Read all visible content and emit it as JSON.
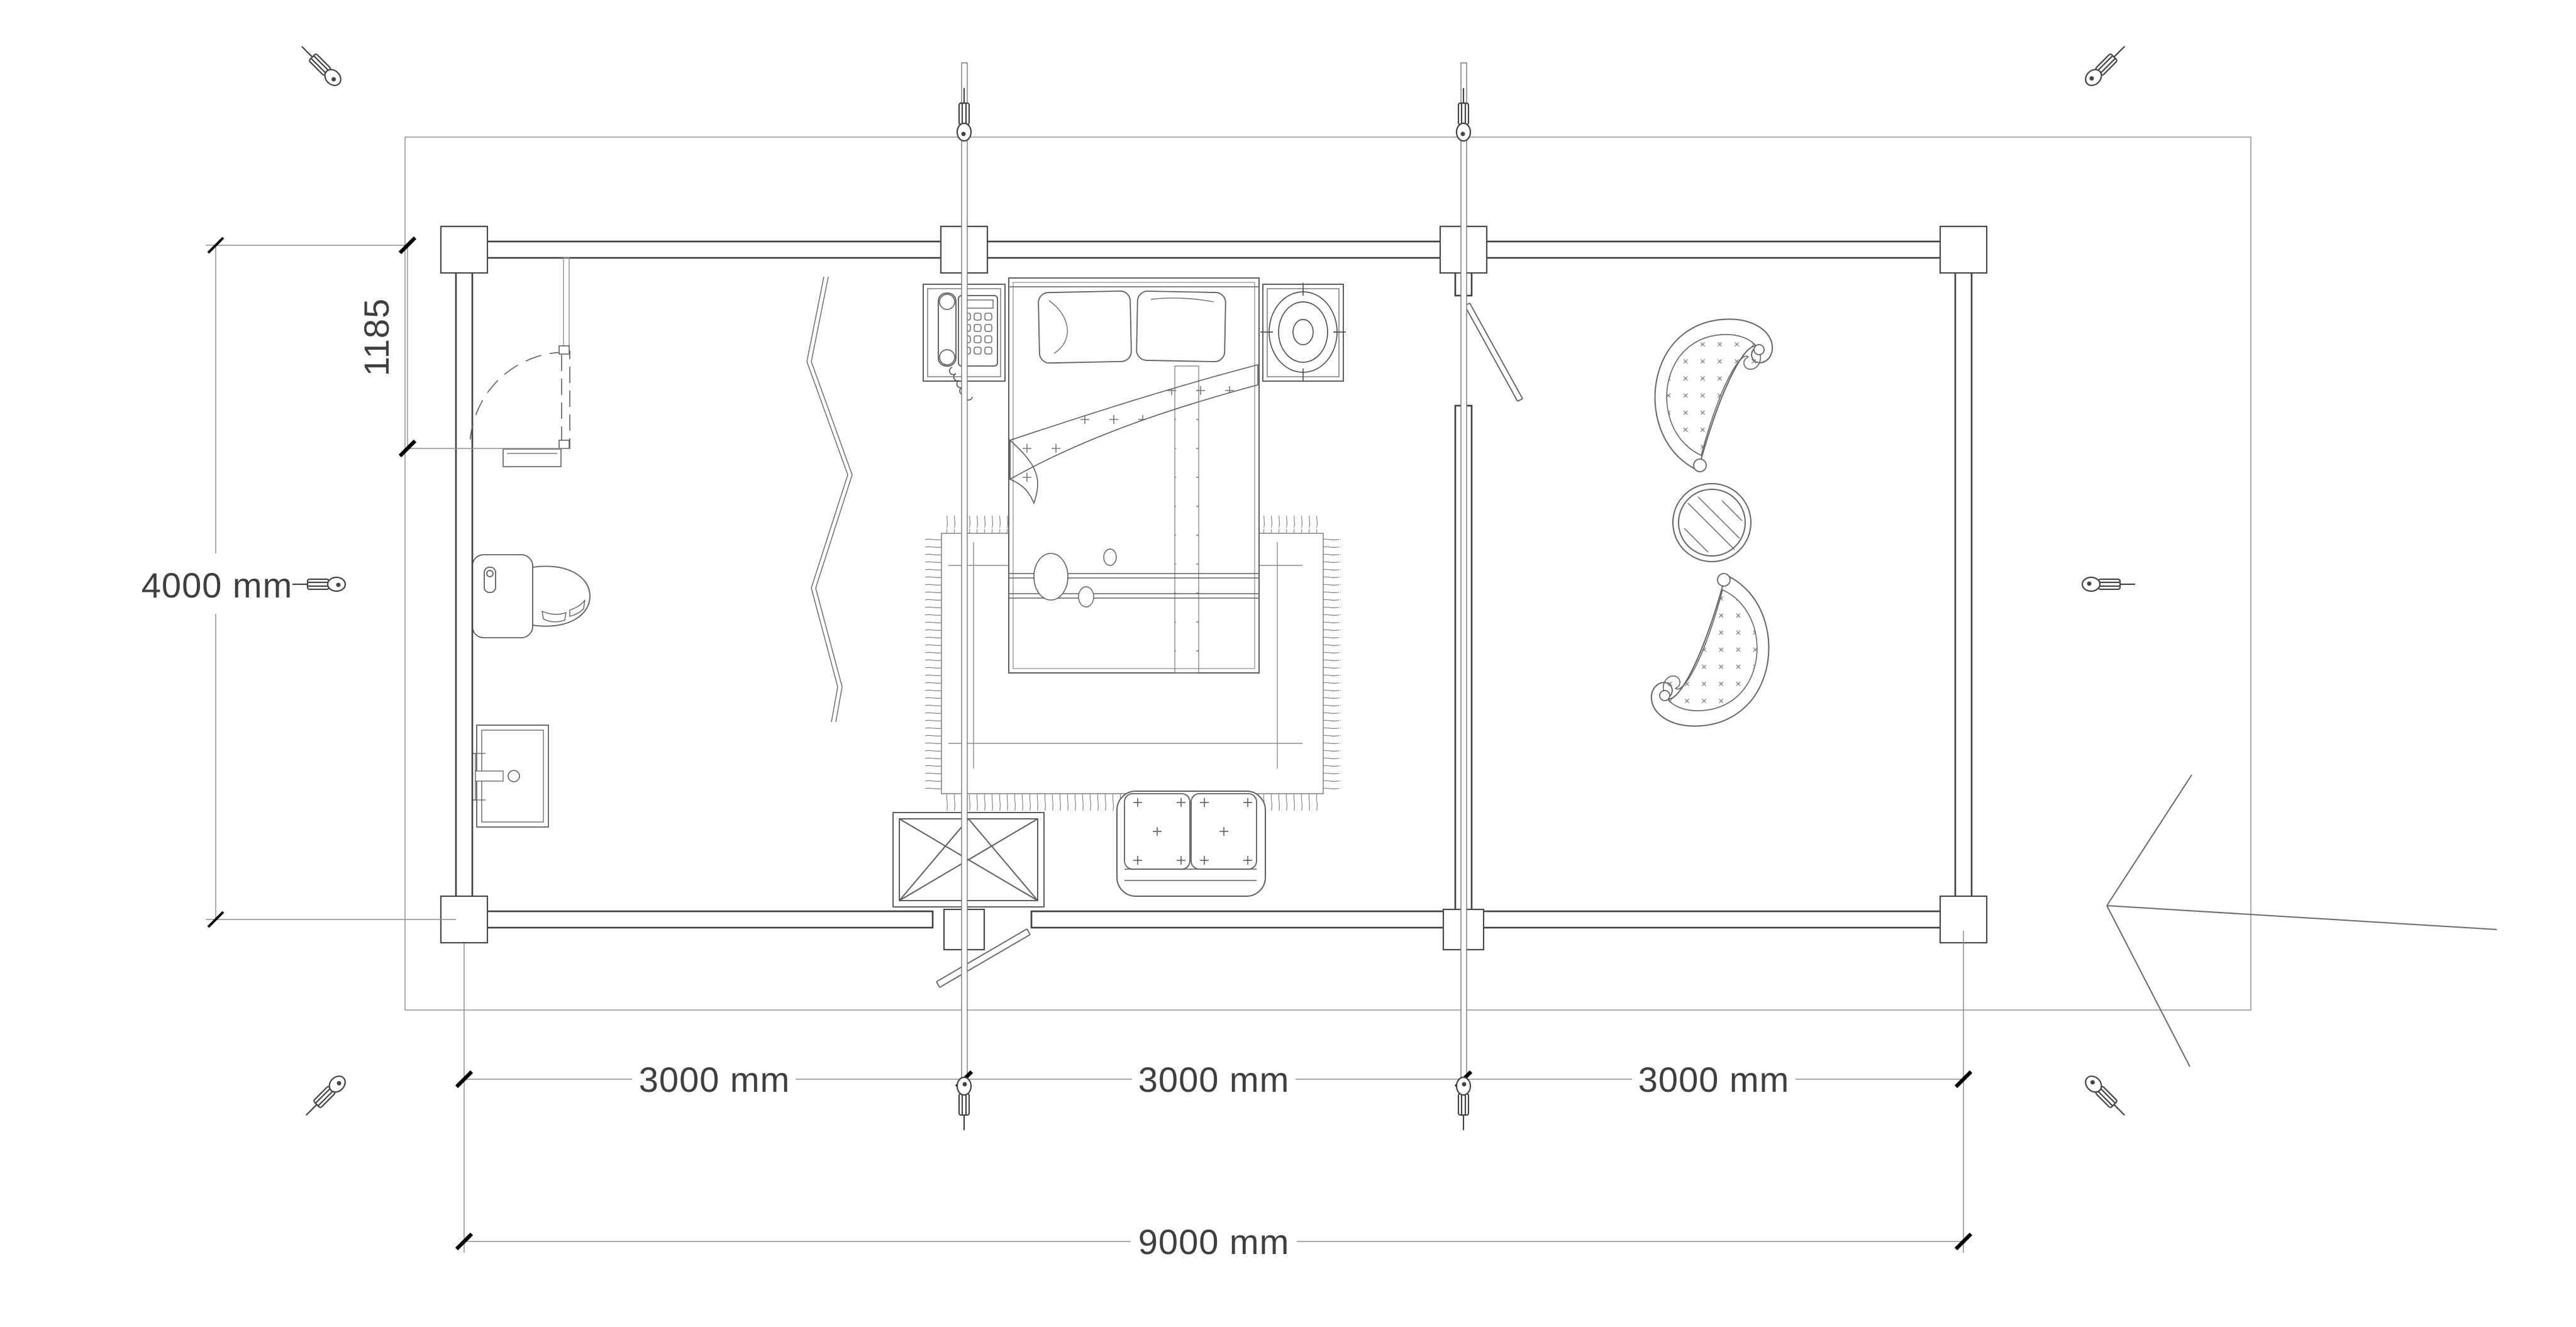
{
  "drawing": {
    "type": "cabin-floor-plan",
    "background": "#ffffff",
    "colors": {
      "walls": "#3f3f3f",
      "thin_lines": "#8c8c8c",
      "dimension_text": "#3f3f3f",
      "tick_marks": "#000000"
    },
    "dimensions": {
      "height_total_label": "4000 mm",
      "bathroom_inset_label": "1185",
      "segment_labels": [
        "3000 mm",
        "3000 mm",
        "3000 mm"
      ],
      "width_total_label": "9000 mm"
    },
    "icons": {
      "corner_markers": "turnbuckle-anchor-icon",
      "side_markers": "turnbuckle-anchor-icon",
      "section_line_ends": "turnbuckle-anchor-icon",
      "entrance": "left-arrow"
    },
    "objects": [
      "toilet",
      "sink",
      "bathroom-door",
      "curtain-partition",
      "phone-nightstand",
      "telephone",
      "double-bed",
      "pillows",
      "blanket",
      "bed-runner",
      "area-rug",
      "loveseat-sofa",
      "window-crossed",
      "entry-door-leaf",
      "terrace-door-leaf",
      "lounge-chair",
      "lounge-chair",
      "round-table",
      "section-grid-lines"
    ]
  }
}
